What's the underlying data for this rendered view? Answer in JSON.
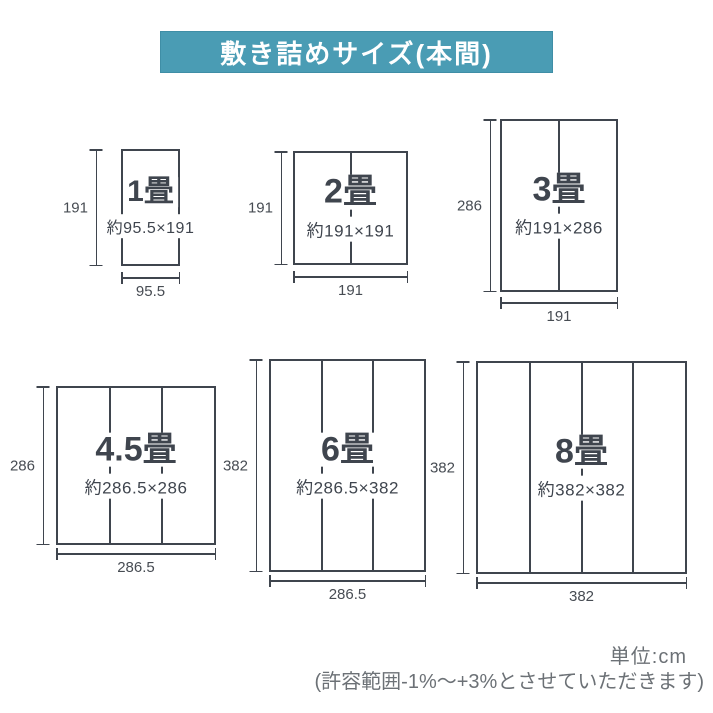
{
  "header": {
    "title": "敷き詰めサイズ(本間)",
    "bg_color": "#4a9cb4",
    "text_color": "#ffffff"
  },
  "diagrams": [
    {
      "label": "1畳",
      "size_text": "約95.5×191",
      "height_cm": "191",
      "width_cm": "95.5",
      "mat_columns": 1
    },
    {
      "label": "2畳",
      "size_text": "約191×191",
      "height_cm": "191",
      "width_cm": "191",
      "mat_columns": 2
    },
    {
      "label": "3畳",
      "size_text": "約191×286",
      "height_cm": "286",
      "width_cm": "191",
      "mat_columns": 2
    },
    {
      "label": "4.5畳",
      "size_text": "約286.5×286",
      "height_cm": "286",
      "width_cm": "286.5",
      "mat_columns": 3
    },
    {
      "label": "6畳",
      "size_text": "約286.5×382",
      "height_cm": "382",
      "width_cm": "286.5",
      "mat_columns": 3
    },
    {
      "label": "8畳",
      "size_text": "約382×382",
      "height_cm": "382",
      "width_cm": "382",
      "mat_columns": 4
    }
  ],
  "footer": {
    "unit_label": "単位:cm",
    "tolerance_note": "(許容範囲-1%〜+3%とさせていただきます)"
  },
  "colors": {
    "line": "#3f454e",
    "dimension_text": "#474c53",
    "note_text": "#6c7176"
  }
}
